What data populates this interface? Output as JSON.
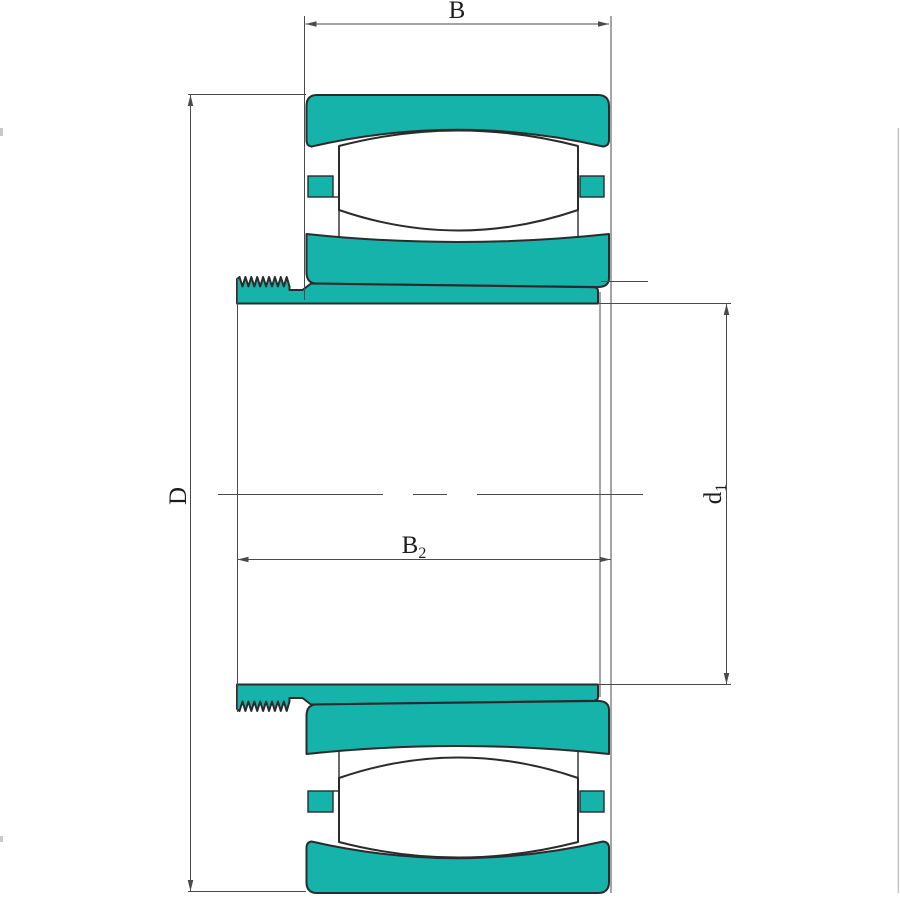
{
  "labels": {
    "b": {
      "base": "B",
      "sub": ""
    },
    "d": {
      "base": "D",
      "sub": ""
    },
    "b2": {
      "base": "B",
      "sub": "2"
    },
    "d1": {
      "base": "d",
      "sub": "1"
    }
  },
  "colors": {
    "part_fill": "#16B3AB",
    "outline": "#2B2B2B",
    "dimension_line": "#4A4A4A",
    "background": "#FFFFFF"
  }
}
